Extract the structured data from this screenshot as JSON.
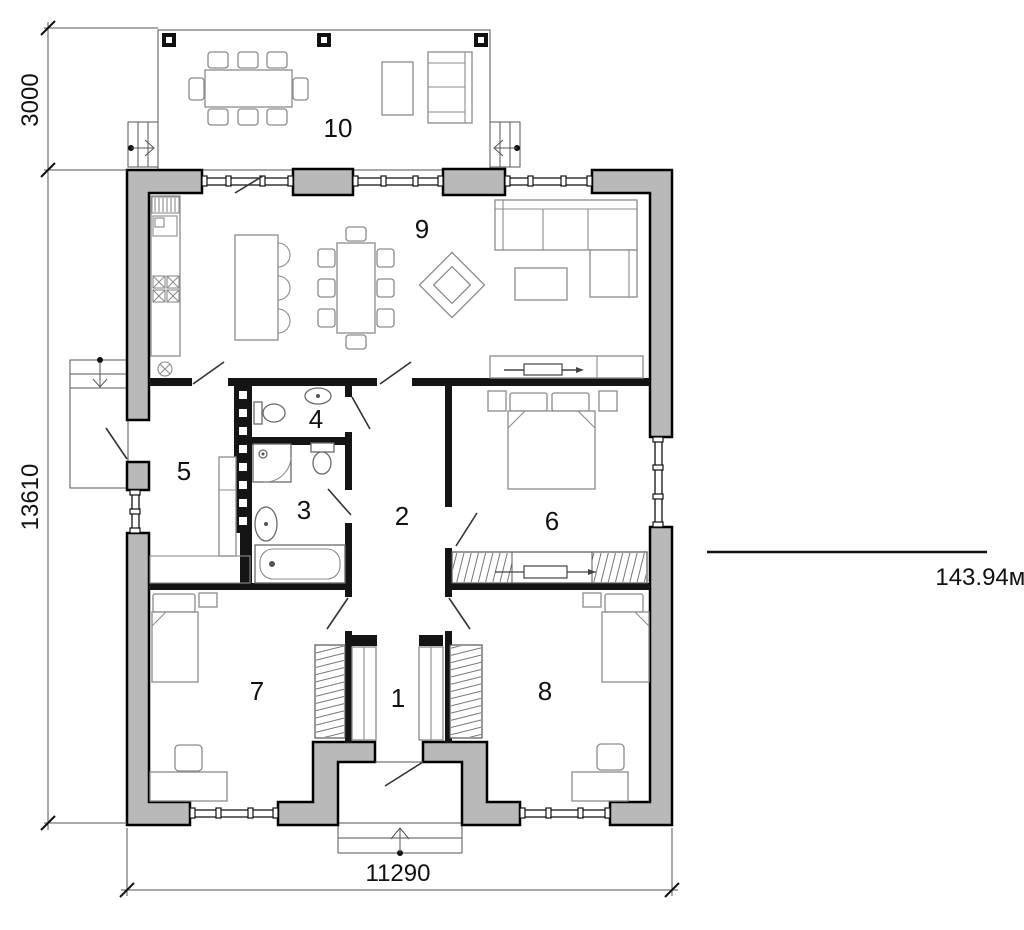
{
  "plan": {
    "rooms": [
      {
        "number": "1"
      },
      {
        "number": "2"
      },
      {
        "number": "3"
      },
      {
        "number": "4"
      },
      {
        "number": "5"
      },
      {
        "number": "6"
      },
      {
        "number": "7"
      },
      {
        "number": "8"
      },
      {
        "number": "9"
      },
      {
        "number": "10"
      }
    ],
    "dimensions": {
      "terrace_depth": "3000",
      "house_length": "13610",
      "house_width": "11290"
    },
    "area_label": "143.94м2",
    "colors": {
      "wall_fill": "#b9b9b9",
      "outline": "#000000",
      "furniture": "#8c8c8c"
    }
  }
}
